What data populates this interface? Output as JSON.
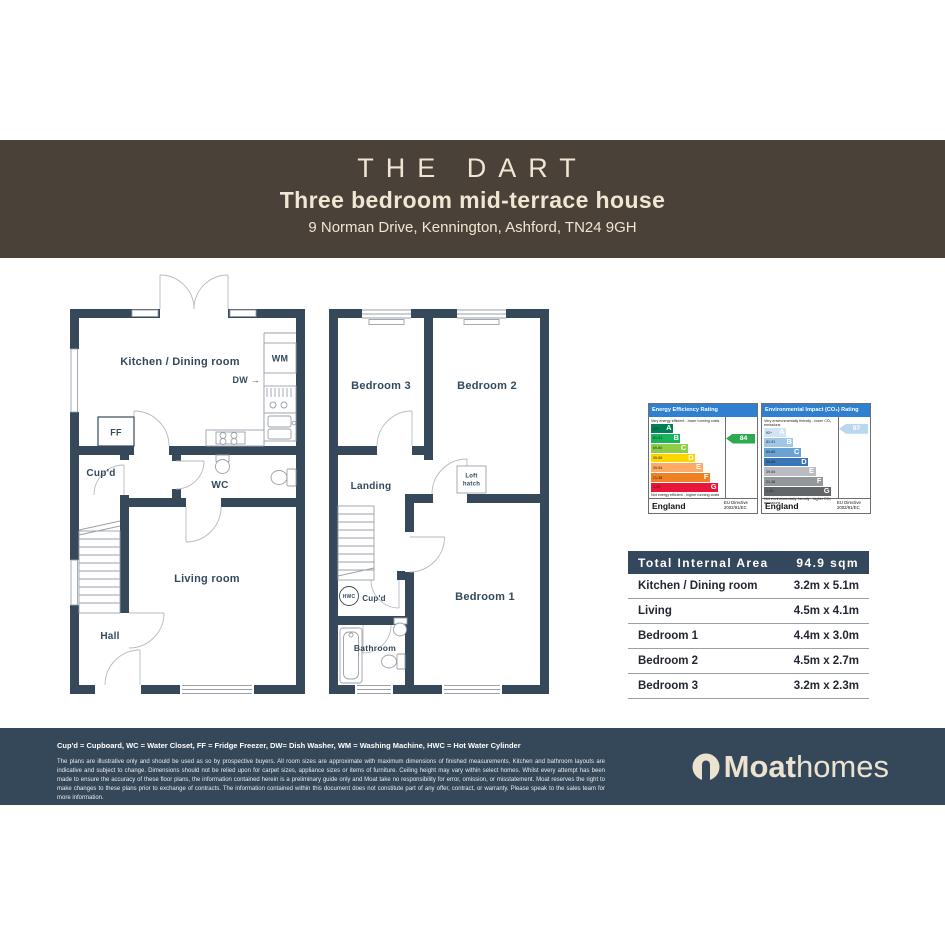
{
  "header": {
    "title": "THE DART",
    "subtitle": "Three bedroom mid-terrace house",
    "address": "9 Norman Drive, Kennington, Ashford, TN24 9GH"
  },
  "ground_floor": {
    "kitchen": "Kitchen / Dining room",
    "wm": "WM",
    "dw": "DW →",
    "ff": "FF",
    "cupd": "Cup'd",
    "wc": "WC",
    "living": "Living room",
    "hall": "Hall"
  },
  "first_floor": {
    "bed3": "Bedroom 3",
    "bed2": "Bedroom 2",
    "landing": "Landing",
    "loft_line1": "Loft",
    "loft_line2": "hatch",
    "hwc": "HWC",
    "cupd": "Cup'd",
    "bathroom": "Bathroom",
    "bed1": "Bedroom 1"
  },
  "epc": {
    "energy": {
      "title": "Energy Efficiency Rating",
      "top_caption": "Very energy efficient - lower running costs",
      "bottom_caption": "Not energy efficient - higher running costs",
      "bands": [
        {
          "letter": "A",
          "range": "92+",
          "color": "#008054",
          "width_pct": 30
        },
        {
          "letter": "B",
          "range": "81-91",
          "color": "#19b459",
          "width_pct": 40
        },
        {
          "letter": "C",
          "range": "69-80",
          "color": "#8dce46",
          "width_pct": 50
        },
        {
          "letter": "D",
          "range": "55-68",
          "color": "#ffd500",
          "width_pct": 60
        },
        {
          "letter": "E",
          "range": "39-54",
          "color": "#fcaa65",
          "width_pct": 70
        },
        {
          "letter": "F",
          "range": "21-38",
          "color": "#ef8023",
          "width_pct": 80
        },
        {
          "letter": "G",
          "range": "1-20",
          "color": "#e9153b",
          "width_pct": 91
        }
      ],
      "current": {
        "value": 84,
        "band": "B",
        "row_index": 1,
        "color": "#2ea94f"
      },
      "footer_left": "England",
      "footer_right": "EU Directive 2002/91/EC"
    },
    "environmental": {
      "title": "Environmental Impact (CO₂) Rating",
      "top_caption": "Very environmentally friendly - lower CO₂ emissions",
      "bottom_caption": "Not environmentally friendly - higher CO₂ emissions",
      "bands": [
        {
          "letter": "A",
          "range": "92+",
          "color": "#cfe5f5",
          "width_pct": 30
        },
        {
          "letter": "B",
          "range": "81-91",
          "color": "#9ec7e8",
          "width_pct": 40
        },
        {
          "letter": "C",
          "range": "69-80",
          "color": "#68a3d3",
          "width_pct": 50
        },
        {
          "letter": "D",
          "range": "55-68",
          "color": "#3a76b6",
          "width_pct": 60
        },
        {
          "letter": "E",
          "range": "39-54",
          "color": "#b9bcc0",
          "width_pct": 70
        },
        {
          "letter": "F",
          "range": "21-38",
          "color": "#939799",
          "width_pct": 80
        },
        {
          "letter": "G",
          "range": "1-20",
          "color": "#636668",
          "width_pct": 91
        }
      ],
      "current": {
        "value": 97,
        "band": "A",
        "row_index": 0,
        "color": "#b9d8ee"
      },
      "footer_left": "England",
      "footer_right": "EU Directive 2002/91/EC"
    }
  },
  "area_table": {
    "header_label": "Total Internal Area",
    "header_value": "94.9 sqm",
    "rows": [
      {
        "label": "Kitchen / Dining room",
        "size": "3.2m x 5.1m"
      },
      {
        "label": "Living",
        "size": "4.5m x 4.1m"
      },
      {
        "label": "Bedroom 1",
        "size": "4.4m x 3.0m"
      },
      {
        "label": "Bedroom 2",
        "size": "4.5m x 2.7m"
      },
      {
        "label": "Bedroom 3",
        "size": "3.2m x 2.3m"
      }
    ]
  },
  "footer": {
    "legend": "Cup'd = Cupboard, WC = Water Closet, FF = Fridge Freezer, DW= Dish Washer, WM = Washing Machine, HWC = Hot Water Cylinder",
    "disclaimer": "The plans are illustrative only and should be used as so by prospective buyers. All room sizes are approximate with maximum dimensions of finished measurements. Kitchen and bathroom layouts are indicative and subject to change. Dimensions should not be relied upon for carpet sizes, appliance sizes or items of furniture. Ceiling height may vary within select homes. Whilst every attempt has been made to ensure the accuracy of these floor plans, the information contained herein is a preliminary guide only and Moat take no responsibility for error, omission, or misstatement. Moat reserves the right to make changes to these plans prior to exchange of contracts. The information contained within this document does not constitute part of any offer, contract, or warranty. Please speak to the sales team for more information.",
    "logo_bold": "Moat",
    "logo_light": "homes"
  }
}
